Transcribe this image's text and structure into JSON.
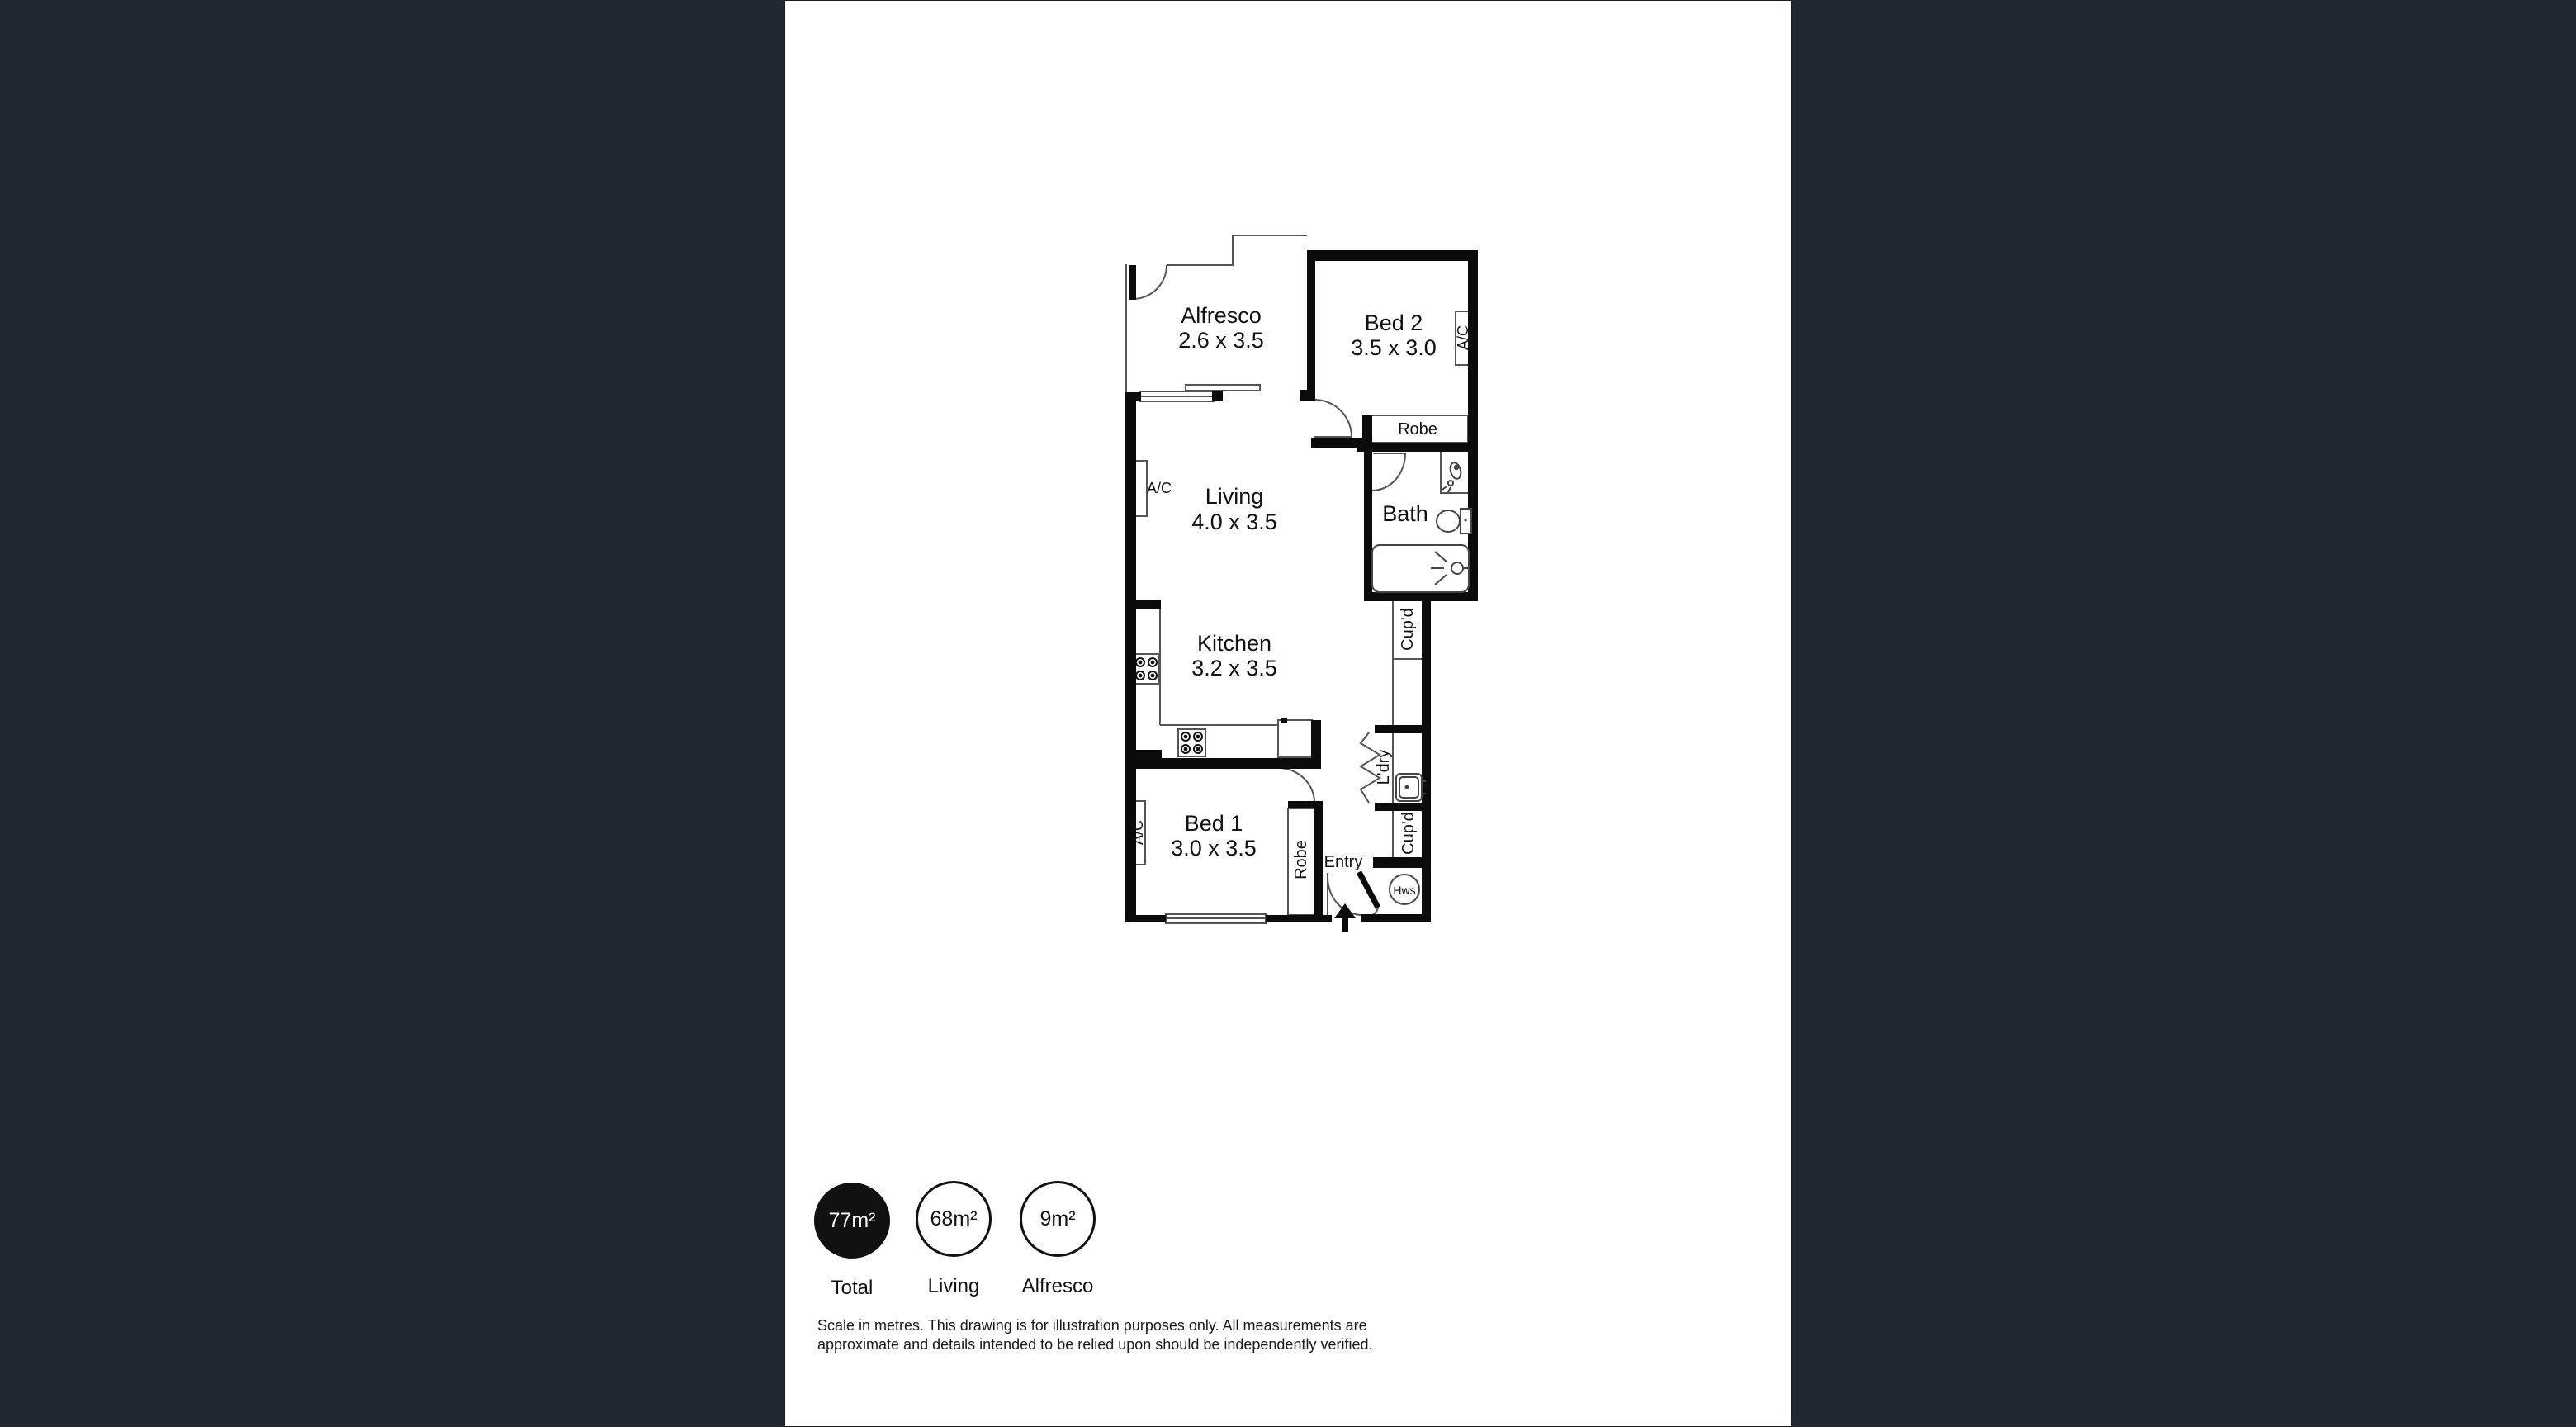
{
  "colors": {
    "background": "#222831",
    "sheet": "#ffffff",
    "wall": "#0b0b0b",
    "thin_line": "#555555",
    "text": "#111111"
  },
  "plan": {
    "rooms": {
      "alfresco": {
        "name": "Alfresco",
        "dims": "2.6 x 3.5"
      },
      "bed2": {
        "name": "Bed 2",
        "dims": "3.5 x 3.0"
      },
      "living": {
        "name": "Living",
        "dims": "4.0 x 3.5"
      },
      "bath": {
        "name": "Bath"
      },
      "kitchen": {
        "name": "Kitchen",
        "dims": "3.2 x 3.5"
      },
      "bed1": {
        "name": "Bed 1",
        "dims": "3.0 x 3.5"
      },
      "entry": {
        "name": "Entry"
      }
    },
    "fixtures": {
      "ac": "A/C",
      "robe": "Robe",
      "cupd": "Cup'd",
      "ldry": "L'dry",
      "hws": "Hws"
    }
  },
  "stats": [
    {
      "value": "77m²",
      "label": "Total",
      "filled": true
    },
    {
      "value": "68m²",
      "label": "Living",
      "filled": false
    },
    {
      "value": "9m²",
      "label": "Alfresco",
      "filled": false
    }
  ],
  "footer": {
    "disclaimer": "Scale in metres. This drawing is for illustration purposes only. All measurements are approximate and details intended to be relied upon should be independently verified."
  }
}
